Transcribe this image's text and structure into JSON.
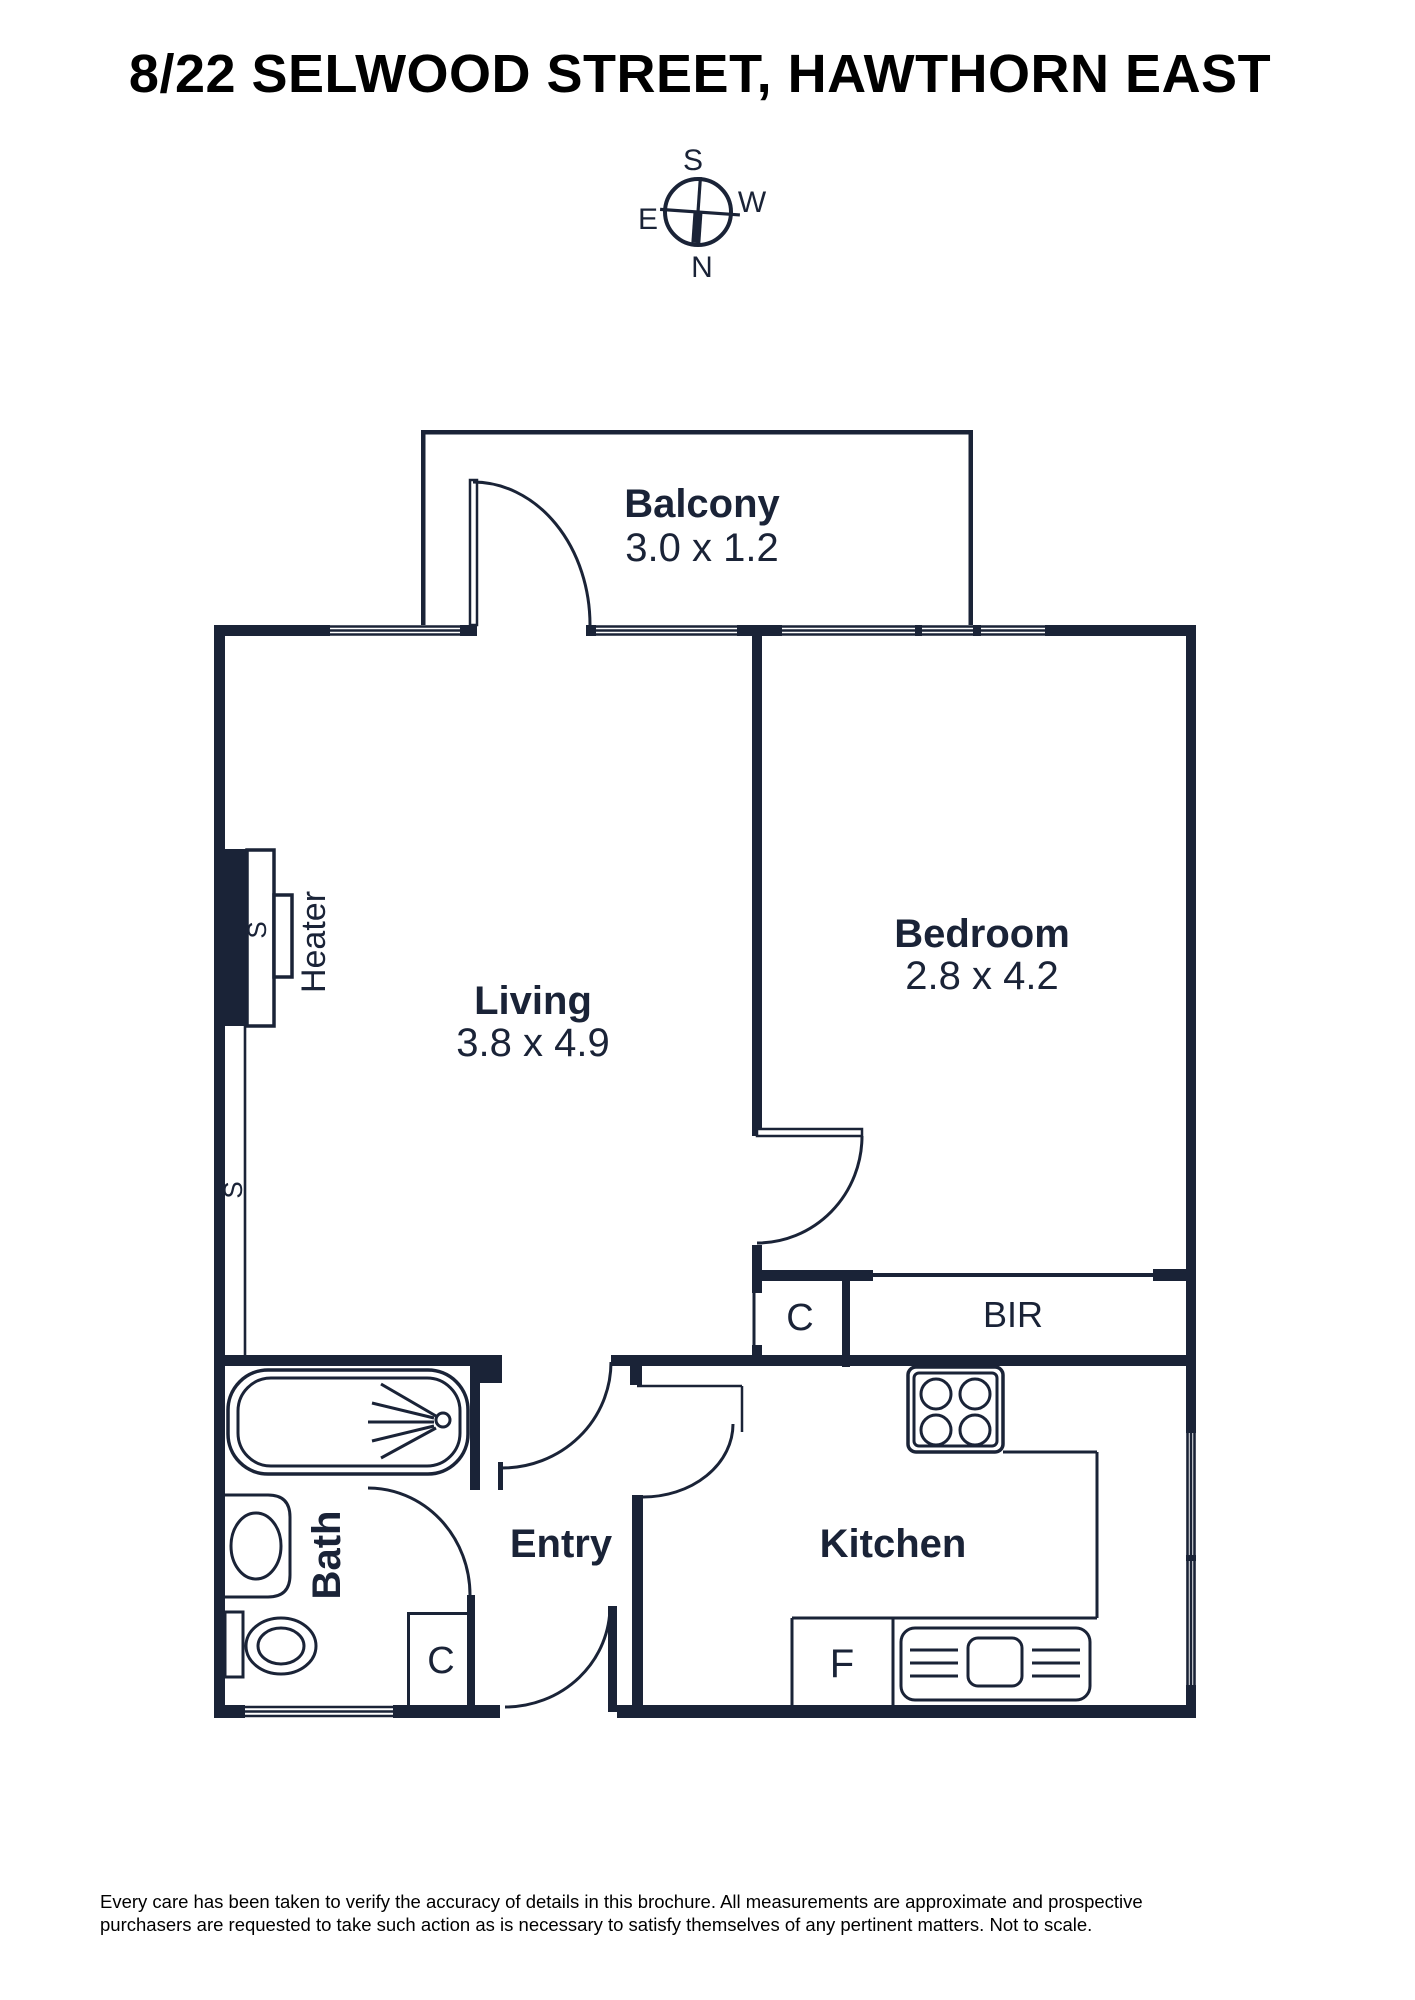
{
  "title": "8/22 SELWOOD STREET, HAWTHORN EAST",
  "compass": {
    "top": "S",
    "right": "W",
    "left": "E",
    "bottom": "N"
  },
  "rooms": {
    "balcony": {
      "name": "Balcony",
      "dims": "3.0 x 1.2"
    },
    "living": {
      "name": "Living",
      "dims": "3.8 x 4.9"
    },
    "bedroom": {
      "name": "Bedroom",
      "dims": "2.8 x 4.2"
    },
    "bath": {
      "name": "Bath"
    },
    "entry": {
      "name": "Entry"
    },
    "kitchen": {
      "name": "Kitchen"
    }
  },
  "labels": {
    "bir": "BIR",
    "closet_hall": "C",
    "closet_entry": "C",
    "fridge": "F",
    "heater": "Heater",
    "switch_upper": "S",
    "switch_lower": "S"
  },
  "colors": {
    "wall": "#1a2337",
    "title": "#000000",
    "disclaimer": "#000000"
  },
  "disclaimer": {
    "line1": "Every care has been taken to verify the accuracy of details in this brochure. All measurements are approximate and prospective",
    "line2": "purchasers are requested to take such action as is necessary to satisfy themselves of any pertinent matters. Not to scale."
  }
}
